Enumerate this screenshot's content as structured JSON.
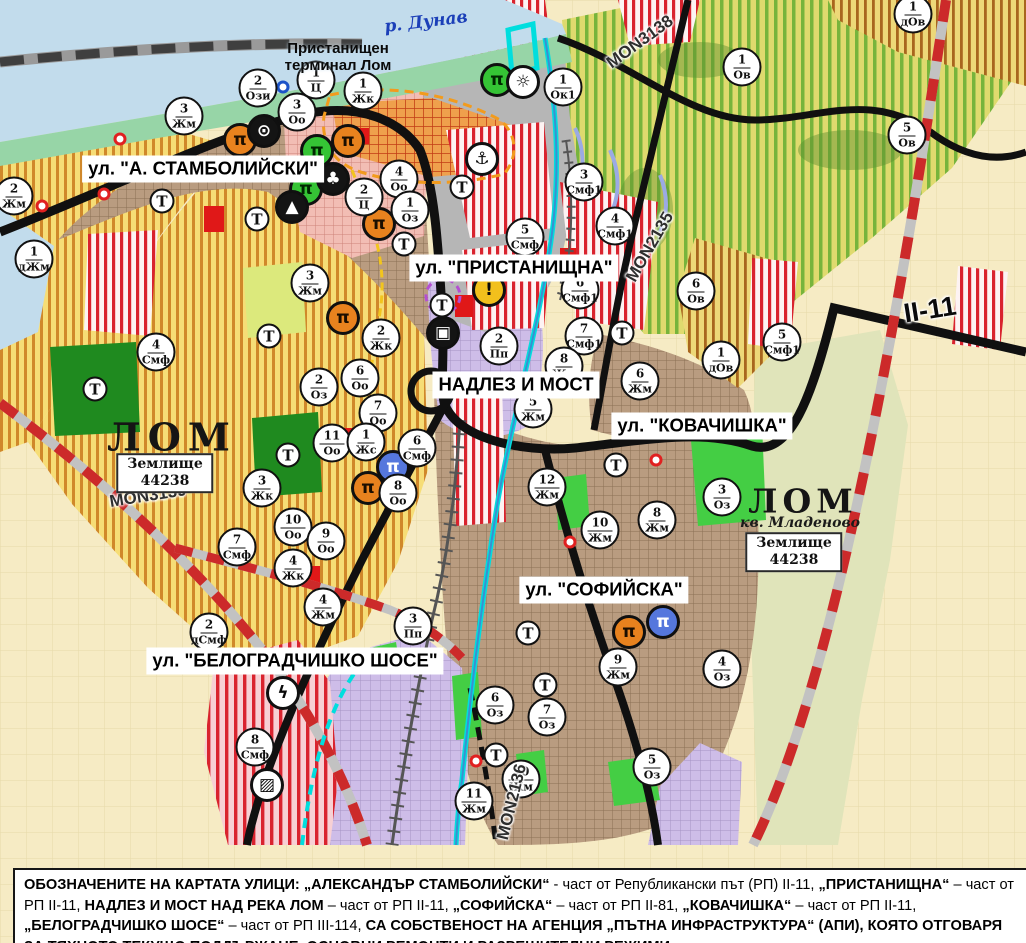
{
  "map": {
    "river_label": "р. Дунав",
    "terminal_label_lines": [
      "Пристанищен",
      "терминал Лом"
    ],
    "city_west": "ЛОМ",
    "city_east": "ЛОМ",
    "district_east": "кв. Младеново",
    "land_box": [
      "Землище",
      "44238"
    ],
    "t_label": "Т",
    "street_labels": [
      {
        "text": "ул. \"А. СТАМБОЛИЙСКИ\""
      },
      {
        "text": "ул. \"ПРИСТАНИЩНА\""
      },
      {
        "text": "НАДЛЕЗ И МОСТ"
      },
      {
        "text": "ул. \"КОВАЧИШКА\""
      },
      {
        "text": "ул. \"СОФИЙСКА\""
      },
      {
        "text": "ул. \"БЕЛОГРАДЧИШКО ШОСЕ\""
      }
    ],
    "road_labels": [
      {
        "text": "MON3138"
      },
      {
        "text": "MON2135"
      },
      {
        "text": "MON3139"
      },
      {
        "text": "MON2136"
      },
      {
        "text": "II-11"
      }
    ],
    "markers": [
      {
        "n": "2",
        "c": "Ози",
        "x": 258,
        "y": 88
      },
      {
        "n": "1",
        "c": "Ц",
        "x": 316,
        "y": 80
      },
      {
        "n": "1",
        "c": "Жк",
        "x": 363,
        "y": 91
      },
      {
        "n": "3",
        "c": "Оо",
        "x": 297,
        "y": 112
      },
      {
        "n": "3",
        "c": "Жм",
        "x": 184,
        "y": 116
      },
      {
        "n": "2",
        "c": "Жм",
        "x": 14,
        "y": 196
      },
      {
        "n": "1",
        "c": "дЖм",
        "x": 34,
        "y": 259
      },
      {
        "n": "4",
        "c": "Оо",
        "x": 399,
        "y": 179
      },
      {
        "n": "2",
        "c": "Ц",
        "x": 364,
        "y": 197
      },
      {
        "n": "1",
        "c": "Оз",
        "x": 410,
        "y": 210
      },
      {
        "n": "3",
        "c": "Жм",
        "x": 310,
        "y": 283
      },
      {
        "n": "2",
        "c": "Жк",
        "x": 381,
        "y": 338
      },
      {
        "n": "6",
        "c": "Оо",
        "x": 360,
        "y": 378
      },
      {
        "n": "2",
        "c": "Оз",
        "x": 319,
        "y": 387
      },
      {
        "n": "7",
        "c": "Оо",
        "x": 378,
        "y": 413
      },
      {
        "n": "11",
        "c": "Оо",
        "x": 332,
        "y": 443
      },
      {
        "n": "1",
        "c": "Жс",
        "x": 366,
        "y": 442
      },
      {
        "n": "6",
        "c": "Смф",
        "x": 417,
        "y": 448
      },
      {
        "n": "8",
        "c": "Оо",
        "x": 398,
        "y": 493
      },
      {
        "n": "3",
        "c": "Жк",
        "x": 262,
        "y": 488
      },
      {
        "n": "10",
        "c": "Оо",
        "x": 293,
        "y": 527
      },
      {
        "n": "9",
        "c": "Оо",
        "x": 326,
        "y": 541
      },
      {
        "n": "4",
        "c": "Жк",
        "x": 293,
        "y": 568
      },
      {
        "n": "7",
        "c": "Смф",
        "x": 237,
        "y": 547
      },
      {
        "n": "4",
        "c": "Смф",
        "x": 156,
        "y": 352
      },
      {
        "n": "4",
        "c": "Жм",
        "x": 323,
        "y": 607
      },
      {
        "n": "3",
        "c": "Пп",
        "x": 413,
        "y": 626
      },
      {
        "n": "2",
        "c": "дСмф",
        "x": 209,
        "y": 632
      },
      {
        "n": "8",
        "c": "Смф",
        "x": 255,
        "y": 747
      },
      {
        "n": "5",
        "c": "Смф",
        "x": 525,
        "y": 237
      },
      {
        "n": "1",
        "c": "Ок1",
        "x": 563,
        "y": 87
      },
      {
        "n": "3",
        "c": "Смф1",
        "x": 584,
        "y": 182
      },
      {
        "n": "4",
        "c": "Смф1",
        "x": 615,
        "y": 226
      },
      {
        "n": "6",
        "c": "Смф1",
        "x": 580,
        "y": 290
      },
      {
        "n": "7",
        "c": "Смф1",
        "x": 584,
        "y": 336
      },
      {
        "n": "2",
        "c": "Пп",
        "x": 499,
        "y": 346
      },
      {
        "n": "8",
        "c": "Жм",
        "x": 564,
        "y": 366
      },
      {
        "n": "5",
        "c": "Жм",
        "x": 533,
        "y": 409
      },
      {
        "n": "6",
        "c": "Жм",
        "x": 640,
        "y": 381
      },
      {
        "n": "1",
        "c": "дОв",
        "x": 721,
        "y": 360
      },
      {
        "n": "5",
        "c": "Смф1",
        "x": 782,
        "y": 342
      },
      {
        "n": "6",
        "c": "Ов",
        "x": 696,
        "y": 291
      },
      {
        "n": "1",
        "c": "Ов",
        "x": 742,
        "y": 67
      },
      {
        "n": "5",
        "c": "Ов",
        "x": 907,
        "y": 135
      },
      {
        "n": "1",
        "c": "дОв",
        "x": 913,
        "y": 14
      },
      {
        "n": "12",
        "c": "Жм",
        "x": 547,
        "y": 487
      },
      {
        "n": "10",
        "c": "Жм",
        "x": 600,
        "y": 530
      },
      {
        "n": "8",
        "c": "Жм",
        "x": 657,
        "y": 520
      },
      {
        "n": "3",
        "c": "Оз",
        "x": 722,
        "y": 497
      },
      {
        "n": "9",
        "c": "Жм",
        "x": 618,
        "y": 667
      },
      {
        "n": "4",
        "c": "Оз",
        "x": 722,
        "y": 669
      },
      {
        "n": "6",
        "c": "Оз",
        "x": 495,
        "y": 705
      },
      {
        "n": "7",
        "c": "Оз",
        "x": 547,
        "y": 717
      },
      {
        "n": "5",
        "c": "Оз",
        "x": 652,
        "y": 767
      },
      {
        "n": "10",
        "c": "Жм",
        "x": 521,
        "y": 779
      },
      {
        "n": "11",
        "c": "Жм",
        "x": 474,
        "y": 801
      }
    ],
    "t_markers": [
      {
        "x": 162,
        "y": 201
      },
      {
        "x": 257,
        "y": 219
      },
      {
        "x": 269,
        "y": 336
      },
      {
        "x": 288,
        "y": 455
      },
      {
        "x": 95,
        "y": 389
      },
      {
        "x": 404,
        "y": 244
      },
      {
        "x": 442,
        "y": 305
      },
      {
        "x": 462,
        "y": 187
      },
      {
        "x": 622,
        "y": 333
      },
      {
        "x": 616,
        "y": 465
      },
      {
        "x": 528,
        "y": 633
      },
      {
        "x": 545,
        "y": 685
      },
      {
        "x": 496,
        "y": 755
      }
    ],
    "icons": [
      {
        "name": "monument-ruin-icon",
        "glyph": "π",
        "bg": "#E8821E",
        "fg": "#1B0E00",
        "x": 240,
        "y": 140
      },
      {
        "name": "monument-ruin-icon",
        "glyph": "π",
        "bg": "#E8821E",
        "fg": "#1B0E00",
        "x": 348,
        "y": 141
      },
      {
        "name": "monument-ruin-icon",
        "glyph": "π",
        "bg": "#E8821E",
        "fg": "#1B0E00",
        "x": 379,
        "y": 224
      },
      {
        "name": "monument-ruin-icon",
        "glyph": "π",
        "bg": "#E8821E",
        "fg": "#1B0E00",
        "x": 343,
        "y": 318
      },
      {
        "name": "monument-ruin-icon",
        "glyph": "π",
        "bg": "#E8821E",
        "fg": "#1B0E00",
        "x": 368,
        "y": 488
      },
      {
        "name": "monument-ruin-icon",
        "glyph": "π",
        "bg": "#E8821E",
        "fg": "#1B0E00",
        "x": 629,
        "y": 632
      },
      {
        "name": "monument-ruin-icon-green",
        "glyph": "π",
        "bg": "#35C435",
        "fg": "#002800",
        "x": 497,
        "y": 80
      },
      {
        "name": "monument-ruin-icon-green",
        "glyph": "π",
        "bg": "#35C435",
        "fg": "#002800",
        "x": 317,
        "y": 151
      },
      {
        "name": "monument-ruin-icon-green",
        "glyph": "π",
        "bg": "#35C435",
        "fg": "#002800",
        "x": 306,
        "y": 189
      },
      {
        "name": "monument-ruin-icon-blue",
        "glyph": "π",
        "bg": "#5577DD",
        "fg": "#FFFFFF",
        "x": 393,
        "y": 467
      },
      {
        "name": "monument-ruin-icon-blue",
        "glyph": "π",
        "bg": "#5577DD",
        "fg": "#FFFFFF",
        "x": 663,
        "y": 622
      },
      {
        "name": "spring-icon",
        "glyph": "⊙",
        "bg": "#141414",
        "fg": "#FFFFFF",
        "x": 264,
        "y": 131
      },
      {
        "name": "park-monument-icon",
        "glyph": "♣",
        "bg": "#141414",
        "fg": "#FFFFFF",
        "x": 333,
        "y": 179
      },
      {
        "name": "mound-icon",
        "glyph": "▲",
        "bg": "#141414",
        "fg": "#FFFFFF",
        "x": 292,
        "y": 207
      },
      {
        "name": "port-anchor-icon",
        "glyph": "⚓",
        "bg": "#FFFFFF",
        "fg": "#0A0A0A",
        "x": 482,
        "y": 159
      },
      {
        "name": "sun-icon",
        "glyph": "☼",
        "bg": "#FFFFFF",
        "fg": "#0A0A0A",
        "x": 523,
        "y": 82
      },
      {
        "name": "warning-icon",
        "glyph": "!",
        "bg": "#F2C01C",
        "fg": "#0A0A0A",
        "x": 489,
        "y": 290
      },
      {
        "name": "truck-terminal-icon",
        "glyph": "▣",
        "bg": "#141414",
        "fg": "#FFFFFF",
        "x": 443,
        "y": 333
      },
      {
        "name": "power-icon",
        "glyph": "ϟ",
        "bg": "#FFFFFF",
        "fg": "#0A0A0A",
        "x": 283,
        "y": 693
      },
      {
        "name": "rail-crossing-icon",
        "glyph": "▨",
        "bg": "#FFFFFF",
        "fg": "#0A0A0A",
        "x": 267,
        "y": 785
      }
    ],
    "rings": [
      {
        "x": 120,
        "y": 139,
        "color": "red"
      },
      {
        "x": 42,
        "y": 206,
        "color": "red"
      },
      {
        "x": 104,
        "y": 194,
        "color": "red"
      },
      {
        "x": 656,
        "y": 460,
        "color": "red"
      },
      {
        "x": 570,
        "y": 542,
        "color": "red"
      },
      {
        "x": 476,
        "y": 761,
        "color": "red"
      },
      {
        "x": 283,
        "y": 87,
        "color": "blue"
      }
    ],
    "palette": {
      "water": "#C2DCEC",
      "shore_green": "#97D5A7",
      "urban_brown": "#B99C80",
      "production_purple": "#CEBDE8",
      "port_gray": "#B6B6B6",
      "smf_red": "#D9232E",
      "vineyard_green": "#77B43C",
      "residential_yellow": "#F6DD76",
      "park_green": "#44CE44",
      "road_black": "#101010",
      "main_road_red_dash": "#CC2A2A",
      "channel_cyan": "#00DEDE"
    }
  },
  "caption": {
    "segments": [
      {
        "t": "ОБОЗНАЧЕНИТЕ НА КАРТАТА УЛИЦИ: ",
        "b": true
      },
      {
        "t": "„АЛЕКСАНДЪР СТАМБОЛИЙСКИ“",
        "b": true
      },
      {
        "t": " - част от Републикански път (РП) II-11, ",
        "b": false
      },
      {
        "t": "„ПРИСТАНИЩНА“",
        "b": true
      },
      {
        "t": " – част от РП II-11, ",
        "b": false
      },
      {
        "t": "НАДЛЕЗ И МОСТ НАД РЕКА ЛОМ",
        "b": true
      },
      {
        "t": " – част от РП II-11, ",
        "b": false
      },
      {
        "t": "„СОФИЙСКА“",
        "b": true
      },
      {
        "t": " – част от РП II-81, ",
        "b": false
      },
      {
        "t": "„КОВАЧИШКА“",
        "b": true
      },
      {
        "t": " – част от РП II-11, ",
        "b": false
      },
      {
        "t": "„БЕЛОГРАДЧИШКО ШОСЕ“",
        "b": true
      },
      {
        "t": " – част от РП III-114, ",
        "b": false
      },
      {
        "t": "СА СОБСТВЕНОСТ НА АГЕНЦИЯ „ПЪТНА ИНФРАСТРУКТУРА“ (АПИ), КОЯТО ОТГОВАРЯ ЗА ТЯХНОТО ТЕКУЩО ПОДДЪРЖАНЕ, ОСНОВНИ РЕМОНТИ И РАЗРЕШИТЕЛНИ РЕЖИМИ.",
        "b": true
      }
    ]
  }
}
